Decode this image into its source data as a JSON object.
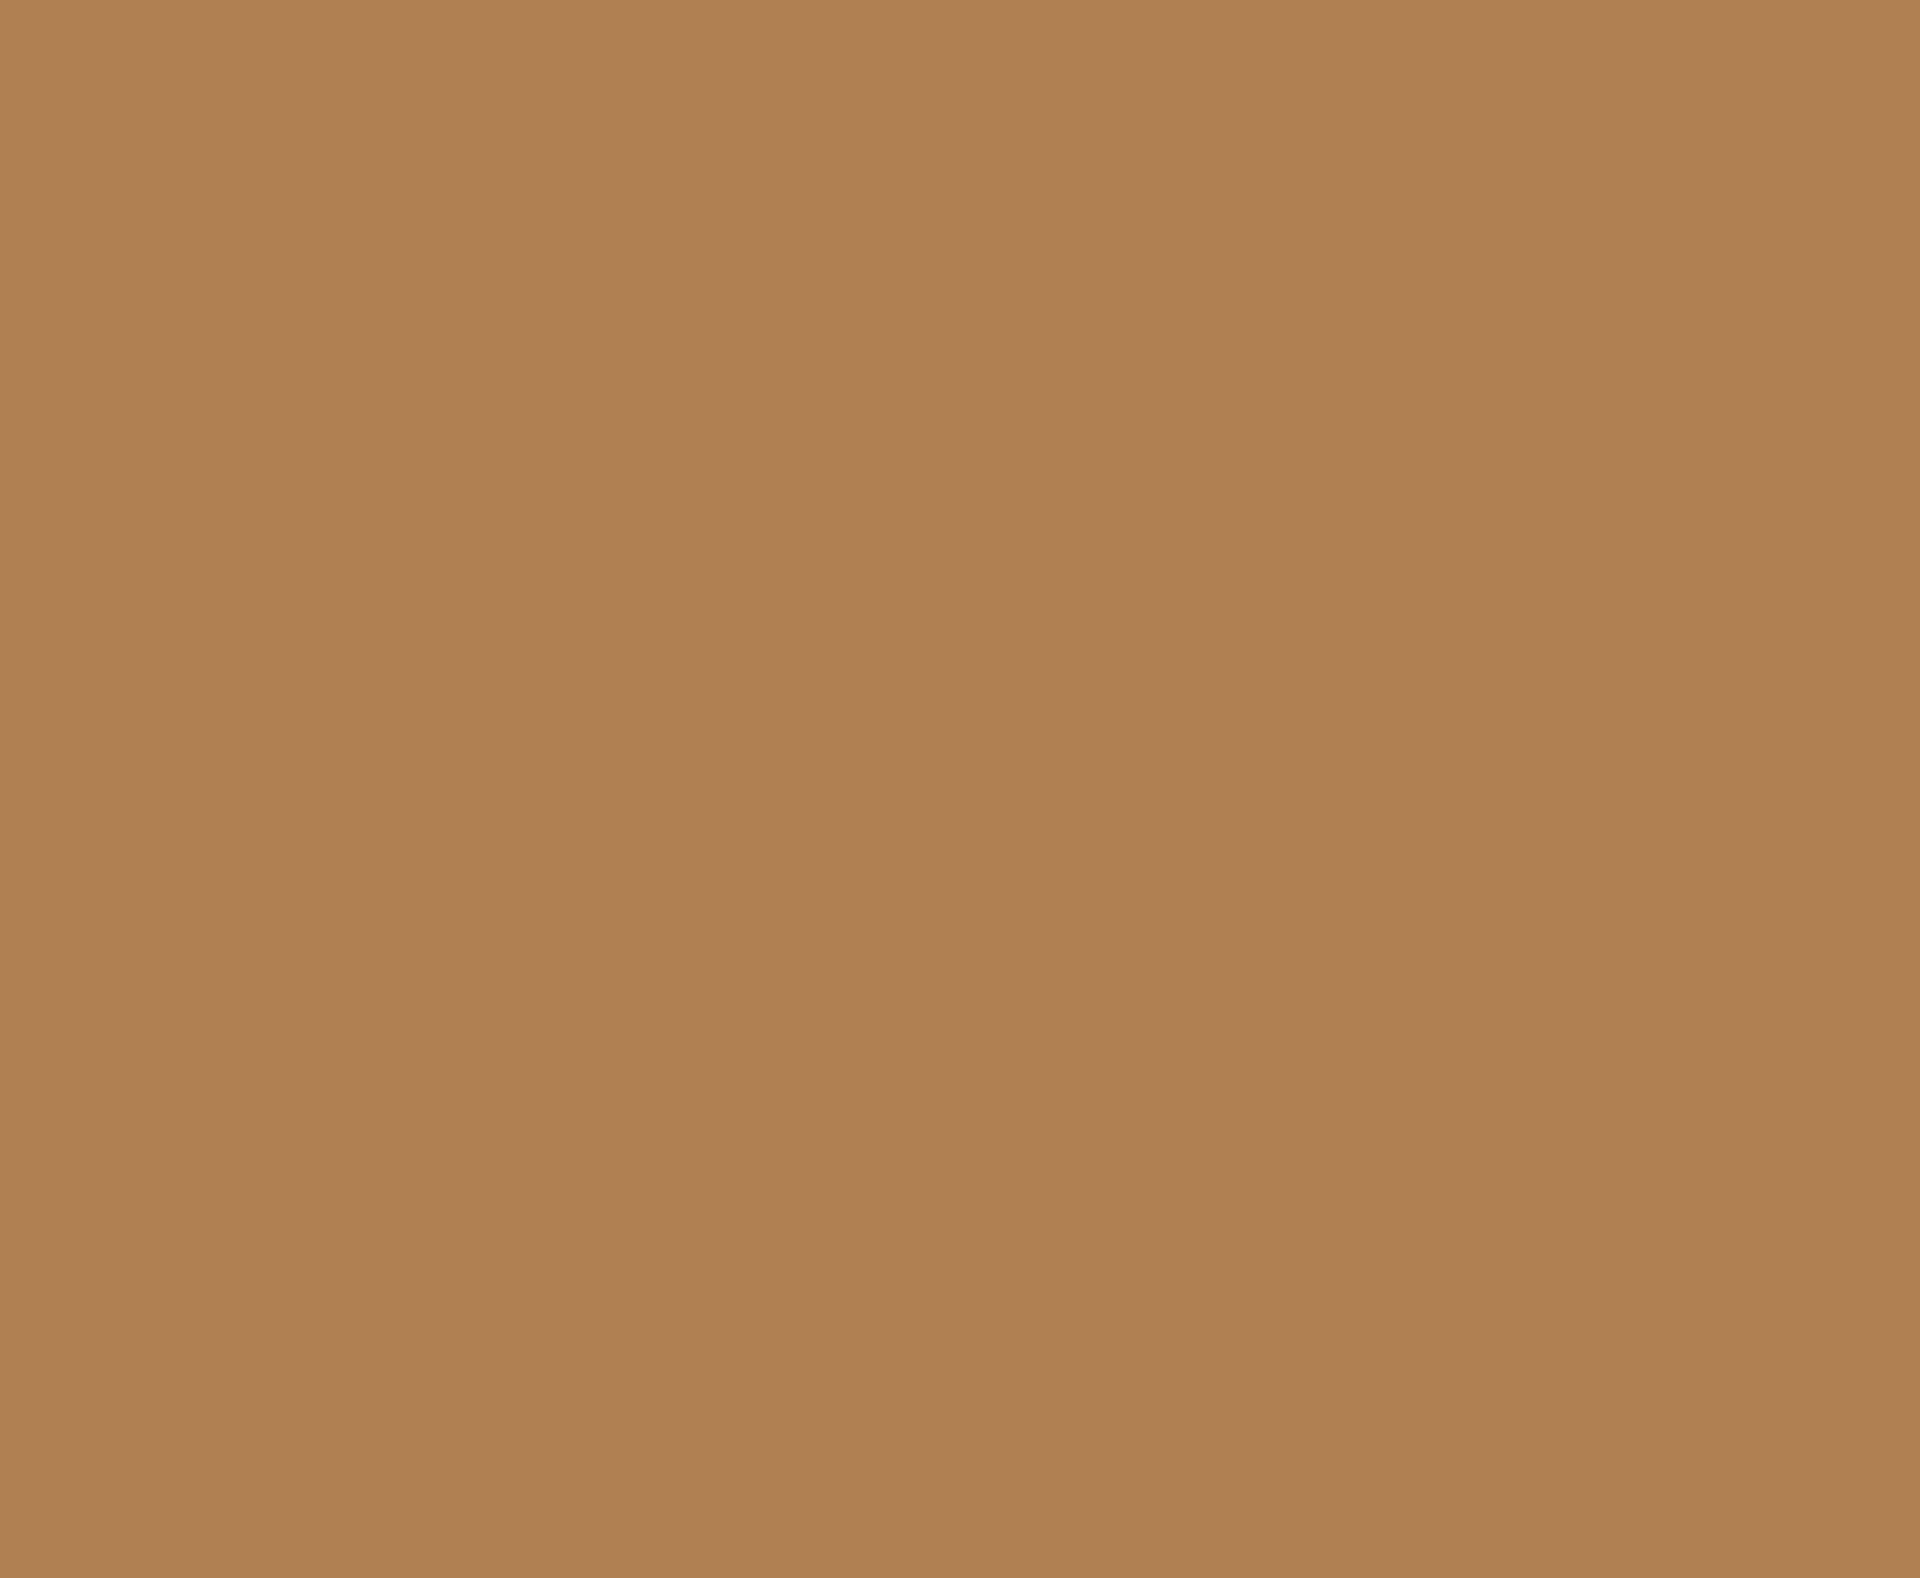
{
  "screen": {
    "description": "Uniform solid-color screen with no visible UI elements, text, or icons",
    "background_color": "#B08052",
    "width_px": 1920,
    "height_px": 1578
  }
}
